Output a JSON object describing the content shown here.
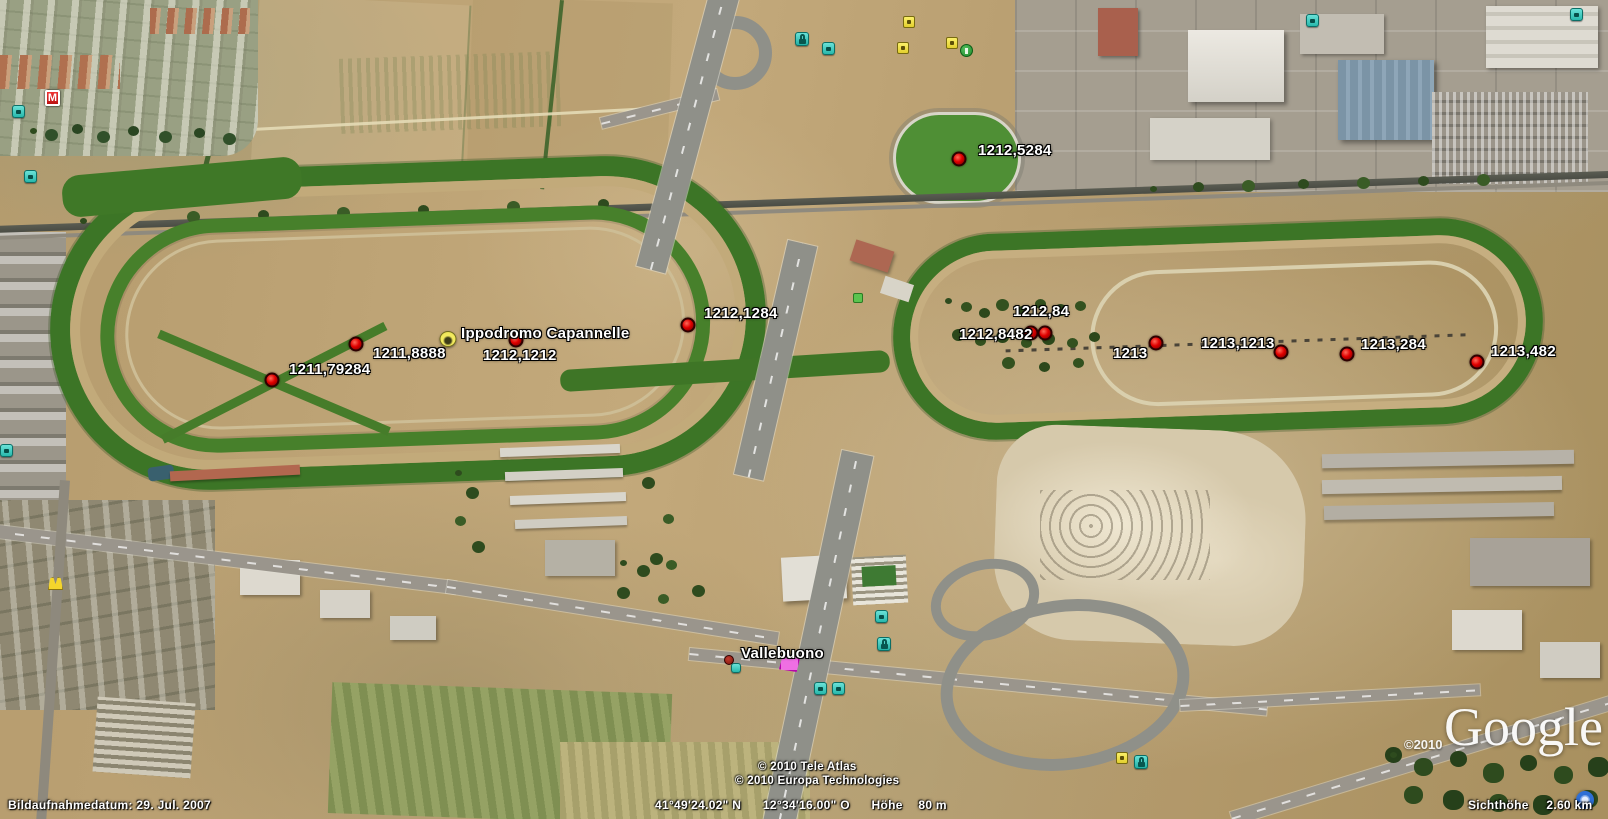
{
  "window": {
    "app": "Google Earth",
    "view": "satellite-imagery"
  },
  "status_bar": {
    "image_date": "Bildaufnahmedatum: 29. Jul. 2007",
    "latitude": "41°49'24.02\" N",
    "longitude": "12°34'16.00\" O",
    "elevation_label": "Höhe",
    "elevation": "80 m",
    "eye_altitude_label": "Sichthöhe",
    "eye_altitude": "2.60 km"
  },
  "attribution": {
    "copyright_line1": "© 2010 Tele Atlas",
    "copyright_line2": "© 2010 Europa Technologies",
    "logo_copyright": "©2010",
    "logo": "Google"
  },
  "placemarks": [
    {
      "label": "1212,5284",
      "type": "point",
      "x": 959,
      "y": 159,
      "label_dx": 19,
      "label_dy": -16
    },
    {
      "label": "1212,1284",
      "type": "point",
      "x": 688,
      "y": 325,
      "label_dx": 16,
      "label_dy": -19
    },
    {
      "label": "1211,8888",
      "type": "point",
      "x": 356,
      "y": 344,
      "label_dx": 17,
      "label_dy": 2
    },
    {
      "label": "1211,79284",
      "type": "point",
      "x": 272,
      "y": 380,
      "label_dx": 17,
      "label_dy": -18
    },
    {
      "label": "1212,1212",
      "type": "point",
      "x": 516,
      "y": 340,
      "label_dx": -33,
      "label_dy": 8
    },
    {
      "label": "Ippodromo Capannelle",
      "type": "site",
      "x": 448,
      "y": 339,
      "label_dx": 13,
      "label_dy": -13
    },
    {
      "label": "1212,84",
      "type": "point",
      "x": 1045,
      "y": 333,
      "label_dx": -32,
      "label_dy": -29
    },
    {
      "label": "1212,8482",
      "type": "point",
      "x": 1031,
      "y": 333,
      "label_dx": -72,
      "label_dy": -6
    },
    {
      "label": "1213",
      "type": "point",
      "x": 1156,
      "y": 343,
      "label_dx": -43,
      "label_dy": 3
    },
    {
      "label": "1213,1213",
      "type": "point",
      "x": 1281,
      "y": 352,
      "label_dx": -80,
      "label_dy": -16
    },
    {
      "label": "1213,284",
      "type": "point",
      "x": 1347,
      "y": 354,
      "label_dx": 14,
      "label_dy": -17
    },
    {
      "label": "1213,482",
      "type": "point",
      "x": 1477,
      "y": 362,
      "label_dx": 14,
      "label_dy": -18
    },
    {
      "label": "Vallebuono",
      "type": "point-small",
      "x": 729,
      "y": 660,
      "label_dx": 12,
      "label_dy": -14
    }
  ],
  "poi_icons": [
    {
      "name": "metro-icon",
      "type": "metro",
      "x": 45,
      "y": 90
    },
    {
      "name": "restaurant-icon",
      "type": "teal",
      "x": 12,
      "y": 105
    },
    {
      "name": "transit-icon",
      "type": "teal",
      "x": 24,
      "y": 170
    },
    {
      "name": "transit-icon-2",
      "type": "teal",
      "x": 0,
      "y": 444
    },
    {
      "name": "fastfood-icon",
      "type": "yellow-arch",
      "x": 48,
      "y": 577
    },
    {
      "name": "shopping-bag-icon",
      "type": "teal-bag",
      "x": 795,
      "y": 32
    },
    {
      "name": "bus-icon",
      "type": "teal",
      "x": 822,
      "y": 42
    },
    {
      "name": "poi-pin-icon",
      "type": "yellow",
      "x": 903,
      "y": 16
    },
    {
      "name": "poi-pin-icon-2",
      "type": "yellow",
      "x": 897,
      "y": 42
    },
    {
      "name": "poi-pin-icon-3",
      "type": "yellow",
      "x": 946,
      "y": 37
    },
    {
      "name": "golf-icon",
      "type": "green",
      "x": 960,
      "y": 44
    },
    {
      "name": "transit-icon-3",
      "type": "teal",
      "x": 1306,
      "y": 14
    },
    {
      "name": "transit-icon-4",
      "type": "teal",
      "x": 1570,
      "y": 8
    },
    {
      "name": "picnic-icon",
      "type": "green-square",
      "x": 853,
      "y": 293
    },
    {
      "name": "transit-icon-5",
      "type": "teal",
      "x": 875,
      "y": 610
    },
    {
      "name": "shopping-bag-icon-2",
      "type": "teal-bag",
      "x": 877,
      "y": 637
    },
    {
      "name": "camera-icon",
      "type": "teal-small",
      "x": 731,
      "y": 663
    },
    {
      "name": "area-marker",
      "type": "pink-poly",
      "x": 779,
      "y": 655
    },
    {
      "name": "wc-icon",
      "type": "teal",
      "x": 814,
      "y": 682
    },
    {
      "name": "wc-icon-2",
      "type": "teal",
      "x": 832,
      "y": 682
    },
    {
      "name": "poi-pin-icon-4",
      "type": "yellow",
      "x": 1116,
      "y": 752
    },
    {
      "name": "shopping-bag-icon-3",
      "type": "teal-bag",
      "x": 1134,
      "y": 755
    },
    {
      "name": "streaming-indicator",
      "type": "blue-ring",
      "x": 1576,
      "y": 791
    }
  ],
  "colors": {
    "terrain_tan": "#b49a6e",
    "track_green": "#3c7526",
    "road_gray": "#8f9089",
    "placemark_red": "#d40000",
    "poi_teal": "#3fd0c8",
    "poi_yellow": "#f2e23a",
    "label_white": "#ffffff"
  }
}
